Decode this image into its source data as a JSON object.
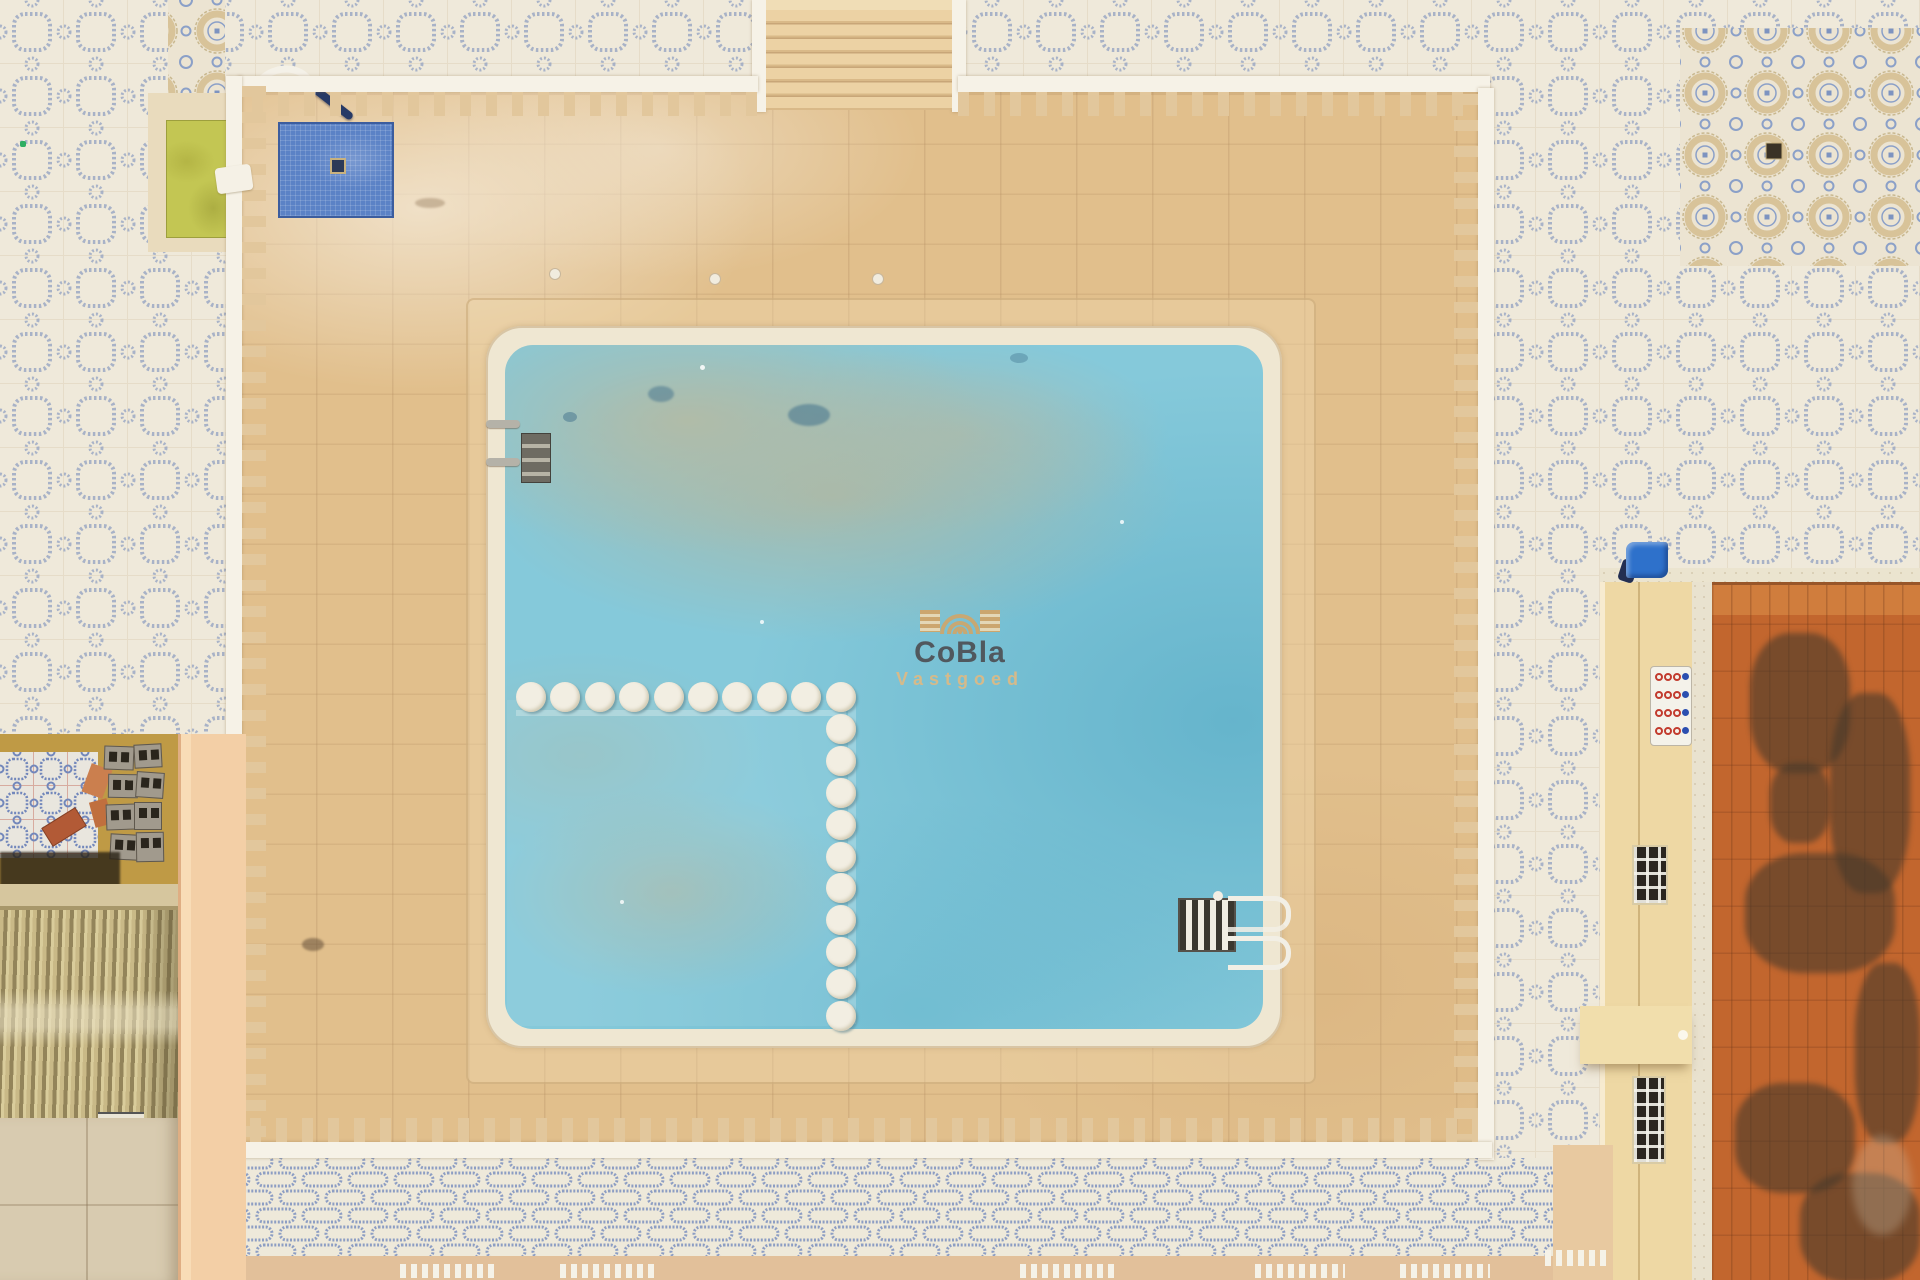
{
  "scene": {
    "title": "Aerial top-down view of an empty community swimming pool with sand-colored deck, white perimeter fence, patterned courtyard tiles, adjacent terracotta roof and outbuildings"
  },
  "watermark": {
    "brand": "CoBla",
    "subtitle": "Vastgoed",
    "brand_color": "#4e5156",
    "subtitle_color": "#ddba85",
    "logo_color": "#d2a567"
  },
  "pool": {
    "divider_discs": {
      "horizontal": 10,
      "vertical": 10
    },
    "ladder_count": 2
  },
  "rules_sign": {
    "rows": 4,
    "cols": 4,
    "red": "#c23b2e",
    "blue": "#2b4fb0"
  },
  "colors": {
    "pool_water": "#85c9da",
    "water_sediment": "#b4bba3",
    "deck_sand": "#e1bf8c",
    "pool_coping": "#efe7d2",
    "fence_white": "#f6f2e7",
    "tile_base": "#efe9da",
    "tile_pattern_blue": "#8b9cc0",
    "chain_wall_blue": "#7d90c0",
    "roof_orange": "#c2662e",
    "building_wall": "#eed8a4",
    "green_mat": "#c3c653",
    "blue_footbath": "#5b82c6",
    "blue_box": "#2e71cb",
    "peach_wall": "#f3cfa6",
    "corrugated_roof": "#b3a470",
    "ground_tan": "#e2c09a"
  }
}
